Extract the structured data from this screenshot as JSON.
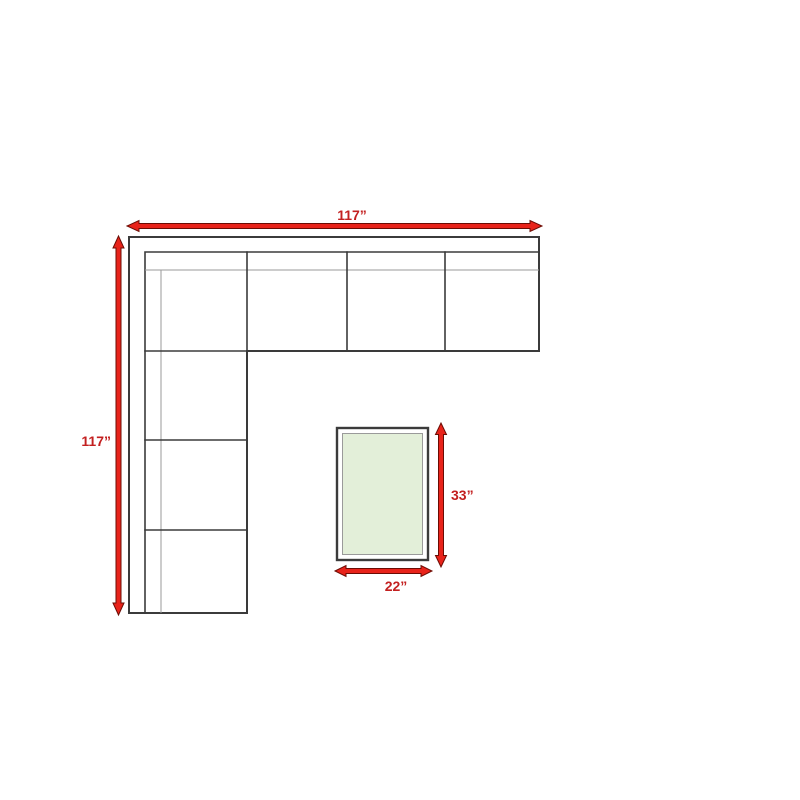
{
  "page": {
    "description": "Furniture dimension diagram: L-shaped sectional sofa top view with rectangular end table",
    "background": "#ffffff"
  },
  "diagram": {
    "type": "furniture-dimension-diagram",
    "sofa": {
      "width_label": "117”",
      "depth_label": "117”",
      "seat_sections_top_arm": 3,
      "seat_sections_left_arm": 3,
      "corner_sections": 1
    },
    "table": {
      "length_label": "33”",
      "width_label": "22”"
    },
    "colors": {
      "arrow_fill": "#e8231a",
      "arrow_outline": "#6b0c04",
      "label_color": "#c32020",
      "sofa_outline": "#3b3b3b",
      "light_line": "#9a9a9a",
      "table_fill": "#e3efd9",
      "background": "#ffffff"
    }
  }
}
